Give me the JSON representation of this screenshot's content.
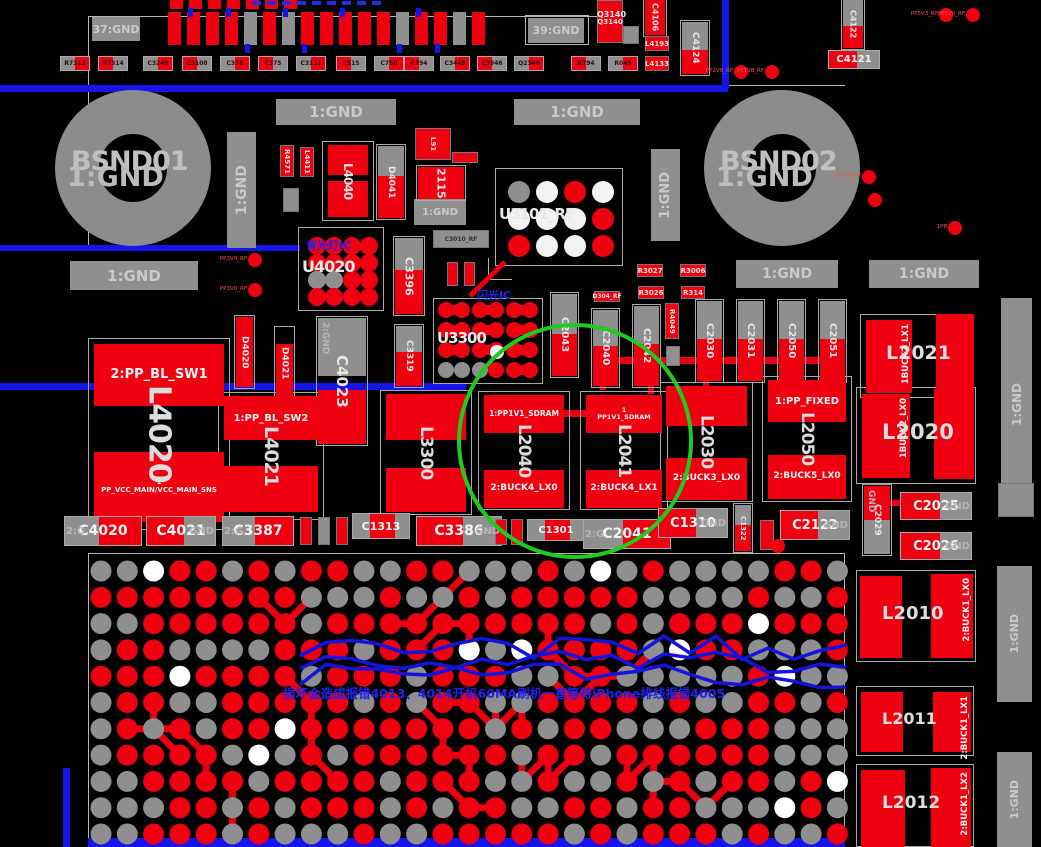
{
  "annotations": {
    "backlight_ic_note": "背光灯IC",
    "flash_ic_note": "闪光IC",
    "damage_warning": "损坏会造成报错4013、4014开机60MA刷机一直等待iPhone排线报错4005"
  },
  "highlight_circle": {
    "color": "#1ecb1e",
    "cx": 575,
    "cy": 441,
    "r": 116,
    "highlights": "L2040 L2041"
  },
  "colors": {
    "pad_red": "#ee0011",
    "pad_gray": "#8f8f8f",
    "pad_white": "#f2f2f2",
    "trace_blue": "#1515e8",
    "trace_red": "#e60012",
    "annot_blue": "#2222ee",
    "label_gray": "#c9c9c9"
  },
  "gnd_boxes": [
    {
      "text": "37:GND",
      "x": 92,
      "y": 17,
      "w": 48,
      "h": 24,
      "f": 11
    },
    {
      "text": "39:GND",
      "x": 528,
      "y": 18,
      "w": 56,
      "h": 25,
      "f": 11
    },
    {
      "text": "1:GND",
      "x": 276,
      "y": 99,
      "w": 120,
      "h": 26,
      "f": 15
    },
    {
      "text": "1:GND",
      "x": 514,
      "y": 99,
      "w": 126,
      "h": 26,
      "f": 15
    },
    {
      "text": "1:GND",
      "x": 227,
      "y": 132,
      "w": 29,
      "h": 116,
      "v": 1,
      "f": 14
    },
    {
      "text": "1:GND",
      "x": 651,
      "y": 149,
      "w": 29,
      "h": 92,
      "v": 1,
      "f": 13
    },
    {
      "text": "1:GND",
      "x": 70,
      "y": 261,
      "w": 128,
      "h": 29,
      "f": 15
    },
    {
      "text": "1:GND",
      "x": 736,
      "y": 260,
      "w": 102,
      "h": 28,
      "f": 14
    },
    {
      "text": "1:GND",
      "x": 869,
      "y": 260,
      "w": 110,
      "h": 28,
      "f": 14
    },
    {
      "text": "1:GND",
      "x": 414,
      "y": 199,
      "w": 52,
      "h": 26,
      "f": 10
    },
    {
      "text": "1:GND",
      "x": 1001,
      "y": 298,
      "w": 31,
      "h": 214,
      "v": 1,
      "f": 12
    },
    {
      "text": "1:GND",
      "x": 997,
      "y": 566,
      "w": 35,
      "h": 136,
      "v": 1,
      "f": 11
    },
    {
      "text": "1:GND",
      "x": 997,
      "y": 752,
      "w": 35,
      "h": 95,
      "v": 1,
      "f": 11
    }
  ],
  "rings": [
    {
      "label": "BSND01",
      "overlap": "1:GND",
      "cx": 133,
      "cy": 168,
      "outer": 156,
      "ring": 44
    },
    {
      "label": "BSND02",
      "overlap": "1:GND",
      "cx": 782,
      "cy": 168,
      "outer": 156,
      "ring": 44
    }
  ],
  "inductors_v": [
    {
      "ref": "L4020",
      "x": 88,
      "y": 338,
      "w": 142,
      "h": 192,
      "rf": 30,
      "top": {
        "dy": 6,
        "h": 62,
        "label": "2:PP_BL_SW1",
        "f": 13
      },
      "bot": {
        "dy": 114,
        "h": 70,
        "label": "1\nPP_VCC_MAIN/VCC_MAIN_SNS",
        "f": 7
      }
    },
    {
      "ref": "L4021",
      "x": 218,
      "y": 392,
      "w": 106,
      "h": 128,
      "rf": 19,
      "top": {
        "dy": 4,
        "h": 44,
        "label": "1:PP_BL_SW2",
        "f": 10
      },
      "bot": {
        "dy": 74,
        "h": 46,
        "label": "",
        "f": 8
      }
    },
    {
      "ref": "L3300",
      "x": 380,
      "y": 390,
      "w": 92,
      "h": 125,
      "rf": 17,
      "top": {
        "dy": 4,
        "h": 46,
        "label": "",
        "f": 8
      },
      "bot": {
        "dy": 78,
        "h": 44,
        "label": "",
        "f": 8
      }
    },
    {
      "ref": "L2040",
      "x": 478,
      "y": 391,
      "w": 92,
      "h": 119,
      "rf": 17,
      "top": {
        "dy": 4,
        "h": 38,
        "label": "1:PP1V1_SDRAM",
        "f": 7.5
      },
      "bot": {
        "dy": 79,
        "h": 38,
        "label": "2:BUCK4_LX0",
        "f": 9
      }
    },
    {
      "ref": "L2041",
      "x": 580,
      "y": 391,
      "w": 88,
      "h": 119,
      "rf": 17,
      "top": {
        "dy": 4,
        "h": 38,
        "label": "1\nPP1V1_SDRAM",
        "f": 6.5
      },
      "bot": {
        "dy": 79,
        "h": 38,
        "label": "2:BUCK4_LX1",
        "f": 9
      }
    },
    {
      "ref": "L2030",
      "x": 660,
      "y": 382,
      "w": 93,
      "h": 120,
      "rf": 17,
      "top": {
        "dy": 4,
        "h": 40,
        "label": "",
        "f": 8
      },
      "bot": {
        "dy": 76,
        "h": 42,
        "label": "2:BUCK3_LX0",
        "f": 9
      }
    },
    {
      "ref": "L2050",
      "x": 762,
      "y": 376,
      "w": 90,
      "h": 126,
      "rf": 17,
      "top": {
        "dy": 4,
        "h": 42,
        "label": "1:PP_FIXED",
        "f": 10
      },
      "bot": {
        "dy": 79,
        "h": 44,
        "label": "2:BUCK5_LX0",
        "f": 9
      }
    },
    {
      "ref": "L4040",
      "x": 322,
      "y": 141,
      "w": 52,
      "h": 80,
      "rf": 12,
      "top": {
        "dy": 4,
        "h": 30,
        "label": "",
        "f": 8
      },
      "bot": {
        "dy": 40,
        "h": 36,
        "label": "",
        "f": 8
      }
    }
  ],
  "inductors_h": [
    {
      "ref": "L2021",
      "x": 860,
      "y": 314,
      "w": 112,
      "h": 84,
      "rf": 19,
      "l": [
        6,
        6,
        46,
        73
      ],
      "r": [
        76,
        0,
        38,
        82
      ],
      "pin": "1BUCK2_LX1",
      "pinOn": "l"
    },
    {
      "ref": "L2020",
      "x": 856,
      "y": 387,
      "w": 120,
      "h": 97,
      "rf": 21,
      "l": [
        6,
        7,
        48,
        84
      ],
      "r": [
        78,
        2,
        40,
        90
      ],
      "pin": "1BUCK2_LX0",
      "pinOn": "l"
    },
    {
      "ref": "L2010",
      "x": 856,
      "y": 570,
      "w": 120,
      "h": 92,
      "rf": 18,
      "l": [
        4,
        6,
        42,
        82
      ],
      "r": [
        75,
        4,
        42,
        84
      ],
      "pin": "2:BUCK1_LX0",
      "pinOn": "r"
    },
    {
      "ref": "L2011",
      "x": 856,
      "y": 686,
      "w": 118,
      "h": 70,
      "rf": 16,
      "l": [
        5,
        6,
        42,
        60
      ],
      "r": [
        77,
        6,
        38,
        60
      ],
      "pin": "2:BUCK1_LX1",
      "pinOn": "r"
    },
    {
      "ref": "L2012",
      "x": 856,
      "y": 764,
      "w": 118,
      "h": 83,
      "rf": 17,
      "l": [
        5,
        6,
        44,
        77
      ],
      "r": [
        75,
        4,
        40,
        79
      ],
      "pin": "2:BUCK1_LX2",
      "pinOn": "r"
    }
  ],
  "caps_v": [
    {
      "ref": "C4023",
      "x": 318,
      "y": 318,
      "w": 48,
      "grayH": 58,
      "redH": 54,
      "gap": 14,
      "rf": 15,
      "ghost": "2:GND"
    },
    {
      "ref": "C3396",
      "x": 395,
      "y": 238,
      "w": 28,
      "grayH": 32,
      "redH": 44,
      "gap": 0,
      "rf": 11
    },
    {
      "ref": "C3319",
      "x": 396,
      "y": 326,
      "w": 26,
      "grayH": 26,
      "redH": 34,
      "gap": 0,
      "rf": 9
    },
    {
      "ref": "D4041",
      "x": 378,
      "y": 146,
      "w": 26,
      "grayH": 30,
      "redH": 42,
      "gap": 0,
      "rf": 9
    },
    {
      "ref": "C2043",
      "x": 552,
      "y": 294,
      "w": 25,
      "grayH": 40,
      "redH": 42,
      "gap": 0,
      "rf": 10
    },
    {
      "ref": "C2040",
      "x": 593,
      "y": 310,
      "w": 25,
      "grayH": 36,
      "redH": 40,
      "gap": 0,
      "rf": 10
    },
    {
      "ref": "C2042",
      "x": 634,
      "y": 306,
      "w": 25,
      "grayH": 38,
      "redH": 42,
      "gap": 0,
      "rf": 10
    },
    {
      "ref": "C2030",
      "x": 697,
      "y": 301,
      "w": 25,
      "grayH": 38,
      "redH": 42,
      "gap": 0,
      "rf": 10
    },
    {
      "ref": "C2031",
      "x": 738,
      "y": 301,
      "w": 25,
      "grayH": 38,
      "redH": 42,
      "gap": 0,
      "rf": 10
    },
    {
      "ref": "C2050",
      "x": 779,
      "y": 301,
      "w": 25,
      "grayH": 38,
      "redH": 42,
      "gap": 0,
      "rf": 10
    },
    {
      "ref": "C2051",
      "x": 820,
      "y": 301,
      "w": 25,
      "grayH": 38,
      "redH": 42,
      "gap": 0,
      "rf": 10
    },
    {
      "ref": "C4106",
      "x": 645,
      "y": 0,
      "w": 20,
      "grayH": 0,
      "redH": 35,
      "gap": 0,
      "rf": 8
    },
    {
      "ref": "C4124",
      "x": 682,
      "y": 22,
      "w": 26,
      "grayH": 28,
      "redH": 24,
      "gap": 0,
      "rf": 9
    },
    {
      "ref": "C4122",
      "x": 843,
      "y": 0,
      "w": 20,
      "grayH": 26,
      "redH": 22,
      "gap": 0,
      "rf": 8
    },
    {
      "ref": "C1322",
      "x": 735,
      "y": 505,
      "w": 16,
      "grayH": 20,
      "redH": 26,
      "gap": 0,
      "rf": 7
    },
    {
      "ref": "C2029",
      "x": 864,
      "y": 486,
      "w": 26,
      "grayH": 34,
      "redH": 34,
      "gap": 0,
      "rf": 9,
      "redTop": 1,
      "ghost": "GND"
    },
    {
      "ref": "D4020",
      "x": 236,
      "y": 317,
      "w": 17,
      "grayH": 0,
      "redH": 70,
      "gap": 0,
      "rf": 9
    },
    {
      "ref": "D4021",
      "x": 276,
      "y": 328,
      "w": 17,
      "grayH": 0,
      "redH": 54,
      "gap": 16,
      "rf": 9
    },
    {
      "ref": "2115",
      "x": 418,
      "y": 167,
      "w": 46,
      "grayH": 0,
      "redH": 32,
      "gap": 0,
      "rf": 11
    }
  ],
  "caps_h": [
    {
      "ref": "C4020",
      "x": 64,
      "y": 516,
      "w": 78,
      "h": 30,
      "side": "left",
      "ghost": "2:G",
      "f": 14
    },
    {
      "ref": "C4021",
      "x": 146,
      "y": 516,
      "w": 70,
      "h": 30,
      "side": "right",
      "ghost": "GND",
      "f": 14
    },
    {
      "ref": "C3387",
      "x": 222,
      "y": 516,
      "w": 72,
      "h": 30,
      "side": "left",
      "ghost": "2:G",
      "f": 14
    },
    {
      "ref": "C1313",
      "x": 352,
      "y": 513,
      "w": 58,
      "h": 26,
      "side": "mid",
      "ghost": "",
      "f": 11
    },
    {
      "ref": "C3386",
      "x": 416,
      "y": 516,
      "w": 86,
      "h": 30,
      "side": "right",
      "ghost": "GND",
      "f": 14
    },
    {
      "ref": "C1301",
      "x": 527,
      "y": 519,
      "w": 58,
      "h": 22,
      "side": "mid",
      "ghost": "",
      "f": 10
    },
    {
      "ref": "C2041",
      "x": 583,
      "y": 519,
      "w": 88,
      "h": 30,
      "side": "left",
      "ghost": "2:G",
      "f": 14
    },
    {
      "ref": "C1310",
      "x": 658,
      "y": 508,
      "w": 70,
      "h": 30,
      "side": "right",
      "ghost": "GND",
      "f": 13
    },
    {
      "ref": "C2122",
      "x": 780,
      "y": 510,
      "w": 70,
      "h": 30,
      "side": "right",
      "ghost": "GND",
      "f": 13
    },
    {
      "ref": "C2025",
      "x": 900,
      "y": 492,
      "w": 72,
      "h": 28,
      "side": "right",
      "ghost": "GND",
      "f": 13
    },
    {
      "ref": "C2026",
      "x": 900,
      "y": 532,
      "w": 72,
      "h": 28,
      "side": "right",
      "ghost": "GND",
      "f": 13
    },
    {
      "ref": "C4121",
      "x": 828,
      "y": 50,
      "w": 52,
      "h": 19,
      "side": "right",
      "ghost": "",
      "f": 10
    }
  ],
  "bga_chips": [
    {
      "ref": "U4020",
      "x": 298,
      "y": 227,
      "w": 86,
      "h": 84,
      "cols": 4,
      "rows": 4,
      "r": 9,
      "colors": [
        "r",
        "r",
        "r",
        "r",
        "r",
        "r",
        "r",
        "r",
        "g",
        "g",
        "r",
        "r",
        "r",
        "r",
        "r",
        "r"
      ],
      "rf": 16,
      "note": "backlight_ic_note",
      "noteXY": [
        8,
        10
      ]
    },
    {
      "ref": "U3101_RF",
      "x": 495,
      "y": 168,
      "w": 128,
      "h": 98,
      "cols": 4,
      "rows": 3,
      "r": 11,
      "colors": [
        "g",
        "w",
        "r",
        "w",
        "w",
        "w",
        "w",
        "r",
        "r",
        "w",
        "w",
        "r"
      ],
      "rf": 15,
      "note": null
    },
    {
      "ref": "U3300",
      "x": 433,
      "y": 298,
      "w": 110,
      "h": 86,
      "pairs": 3,
      "rows": 4,
      "r": 8,
      "rowColors": [
        "rrrrrr",
        "rrrrrr",
        "rrrrrr",
        "gggrrr"
      ],
      "whiteDot": [
        64,
        54
      ],
      "rf": 15,
      "note": "flash_ic_note",
      "noteXY": [
        44,
        -11
      ]
    }
  ],
  "small_parts": [
    {
      "ref": "R4571",
      "x": 280,
      "y": 145,
      "w": 14,
      "h": 32,
      "c": "red",
      "v": 1
    },
    {
      "ref": "L4411",
      "x": 300,
      "y": 147,
      "w": 14,
      "h": 30,
      "c": "red",
      "v": 1
    },
    {
      "ref": "",
      "x": 283,
      "y": 188,
      "w": 16,
      "h": 24,
      "c": "gray",
      "v": 1
    },
    {
      "ref": "L91",
      "x": 415,
      "y": 128,
      "w": 36,
      "h": 32,
      "c": "red",
      "v": 1
    },
    {
      "ref": "",
      "x": 452,
      "y": 152,
      "w": 26,
      "h": 11,
      "c": "red"
    },
    {
      "ref": "C3010_RF",
      "x": 433,
      "y": 230,
      "w": 56,
      "h": 18,
      "c": "gray"
    },
    {
      "ref": "",
      "x": 447,
      "y": 262,
      "w": 11,
      "h": 24,
      "c": "red",
      "v": 1
    },
    {
      "ref": "",
      "x": 464,
      "y": 262,
      "w": 11,
      "h": 24,
      "c": "red",
      "v": 1
    },
    {
      "ref": "D304_RF",
      "x": 594,
      "y": 291,
      "w": 26,
      "h": 11,
      "c": "red"
    },
    {
      "ref": "R3027",
      "x": 637,
      "y": 264,
      "w": 26,
      "h": 13,
      "c": "red"
    },
    {
      "ref": "R3006",
      "x": 680,
      "y": 264,
      "w": 26,
      "h": 13,
      "c": "red"
    },
    {
      "ref": "R3026",
      "x": 638,
      "y": 286,
      "w": 26,
      "h": 13,
      "c": "red"
    },
    {
      "ref": "R314",
      "x": 681,
      "y": 286,
      "w": 24,
      "h": 13,
      "c": "red"
    },
    {
      "ref": "R4049",
      "x": 665,
      "y": 303,
      "w": 14,
      "h": 36,
      "c": "red",
      "v": 1
    },
    {
      "ref": "",
      "x": 666,
      "y": 346,
      "w": 14,
      "h": 20,
      "c": "gray",
      "v": 1
    },
    {
      "ref": "L4193",
      "x": 645,
      "y": 36,
      "w": 24,
      "h": 15,
      "c": "red"
    },
    {
      "ref": "L4133",
      "x": 645,
      "y": 56,
      "w": 24,
      "h": 15,
      "c": "red"
    },
    {
      "ref": "",
      "x": 623,
      "y": 26,
      "w": 16,
      "h": 18,
      "c": "gray"
    },
    {
      "ref": "Q3140",
      "x": 597,
      "y": 0,
      "w": 26,
      "h": 43,
      "c": "red"
    },
    {
      "ref": "",
      "x": 998,
      "y": 483,
      "w": 36,
      "h": 34,
      "c": "gray"
    },
    {
      "ref": "",
      "x": 300,
      "y": 517,
      "w": 12,
      "h": 28,
      "c": "red",
      "v": 1
    },
    {
      "ref": "",
      "x": 318,
      "y": 517,
      "w": 12,
      "h": 28,
      "c": "gray",
      "v": 1
    },
    {
      "ref": "",
      "x": 336,
      "y": 517,
      "w": 12,
      "h": 28,
      "c": "red",
      "v": 1
    },
    {
      "ref": "",
      "x": 495,
      "y": 519,
      "w": 12,
      "h": 26,
      "c": "red",
      "v": 1
    },
    {
      "ref": "",
      "x": 511,
      "y": 519,
      "w": 12,
      "h": 26,
      "c": "red",
      "v": 1
    },
    {
      "ref": "",
      "x": 760,
      "y": 520,
      "w": 14,
      "h": 30,
      "c": "red",
      "v": 1
    }
  ],
  "resistor_row": {
    "y": 56,
    "w": 30,
    "h": 15,
    "items": [
      {
        "x": 60,
        "label": "R7313"
      },
      {
        "x": 98,
        "label": "R7314"
      },
      {
        "x": 143,
        "label": "C3249"
      },
      {
        "x": 182,
        "label": "C3108"
      },
      {
        "x": 220,
        "label": "C378"
      },
      {
        "x": 258,
        "label": "C375"
      },
      {
        "x": 296,
        "label": "C3111"
      },
      {
        "x": 336,
        "label": "C515"
      },
      {
        "x": 374,
        "label": "C758"
      },
      {
        "x": 404,
        "label": "C394"
      },
      {
        "x": 440,
        "label": "C3448"
      },
      {
        "x": 477,
        "label": "C3946"
      },
      {
        "x": 514,
        "label": "Q2348"
      },
      {
        "x": 571,
        "label": "R794"
      },
      {
        "x": 608,
        "label": "R045"
      }
    ]
  },
  "top_bars": {
    "x0": 168,
    "y": 12,
    "w": 13,
    "step": 19,
    "h": 33,
    "colors": [
      "r",
      "r",
      "r",
      "r",
      "g",
      "r",
      "g",
      "r",
      "r",
      "r",
      "r",
      "r",
      "g",
      "r",
      "r",
      "g",
      "r"
    ],
    "mini": {
      "x0": 170,
      "y": 0,
      "w": 13,
      "step": 19,
      "h": 9,
      "count": 7
    }
  },
  "pads": [
    {
      "x": 946,
      "y": 15,
      "label": "PP5V3_RF"
    },
    {
      "x": 973,
      "y": 15,
      "label": "PP5V0_RF"
    },
    {
      "x": 741,
      "y": 72,
      "label": "PP2V8_RF"
    },
    {
      "x": 772,
      "y": 72,
      "label": "PP1V8_RF"
    },
    {
      "x": 869,
      "y": 177,
      "label": "PP1V8_RF"
    },
    {
      "x": 875,
      "y": 200,
      "label": ""
    },
    {
      "x": 955,
      "y": 228,
      "label": "1P8"
    },
    {
      "x": 255,
      "y": 260,
      "label": "PP3V0_RF"
    },
    {
      "x": 255,
      "y": 290,
      "label": "PP3V0_RF"
    },
    {
      "x": 778,
      "y": 546,
      "label": ""
    }
  ],
  "traces": {
    "blue": [
      [
        0,
        85,
        728,
        7
      ],
      [
        722,
        0,
        7,
        88
      ],
      [
        0,
        245,
        300,
        6
      ],
      [
        0,
        383,
        466,
        7
      ],
      [
        88,
        838,
        757,
        9
      ],
      [
        63,
        768,
        7,
        79
      ]
    ],
    "red": [
      [
        598,
        357,
        240,
        7
      ],
      [
        600,
        364,
        6,
        26
      ],
      [
        703,
        364,
        6,
        24
      ],
      [
        788,
        364,
        6,
        24
      ],
      [
        550,
        410,
        44,
        7
      ],
      [
        944,
        389,
        7,
        17
      ],
      [
        889,
        500,
        14,
        6
      ],
      [
        648,
        378,
        6,
        16
      ]
    ],
    "white": [
      [
        88,
        16,
        531,
        1
      ],
      [
        88,
        16,
        1,
        234
      ],
      [
        619,
        0,
        1,
        17
      ],
      [
        693,
        85,
        152,
        1
      ],
      [
        88,
        553,
        757,
        1
      ],
      [
        88,
        553,
        1,
        294
      ],
      [
        844,
        553,
        1,
        294
      ],
      [
        525,
        15,
        64,
        30,
        1
      ],
      [
        488,
        258,
        1,
        22
      ],
      [
        488,
        279,
        24,
        1
      ]
    ]
  },
  "bga_field": {
    "x0": 101,
    "y0": 571,
    "cols": 29,
    "rows": 11,
    "pitch": 26.3,
    "r": 10.5,
    "seed": 7,
    "white_th": 0.975,
    "gray_th": 0.42
  },
  "warning_pos": {
    "x": 283,
    "y": 683
  }
}
